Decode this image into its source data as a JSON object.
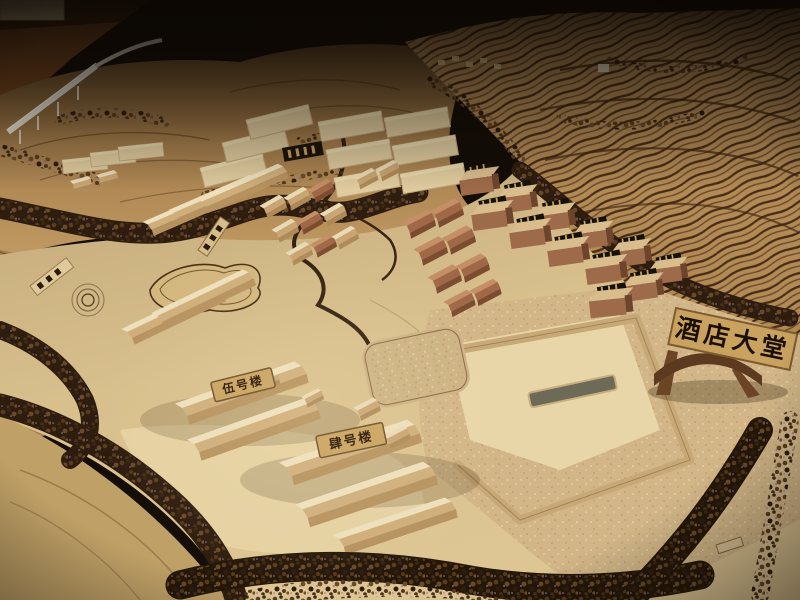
{
  "signs": {
    "hotel_lobby": "酒店大堂",
    "building_5": "伍号楼",
    "building_4": "肆号楼"
  },
  "palette": {
    "background_dark": "#140d07",
    "table_wood": "#74451f",
    "hill_tan": "#a57e4c",
    "terrace_stripe": "#472b14",
    "base_light": "#d8c08d",
    "base_bright": "#e8d6ab",
    "building_cream": "#ece0bf",
    "building_red": "#9c6a47",
    "tree_brown": "#3c2712",
    "plate_tan": "#c9a25f",
    "plate_text": "#1b0f04",
    "viaduct_white": "#ece6d6"
  }
}
